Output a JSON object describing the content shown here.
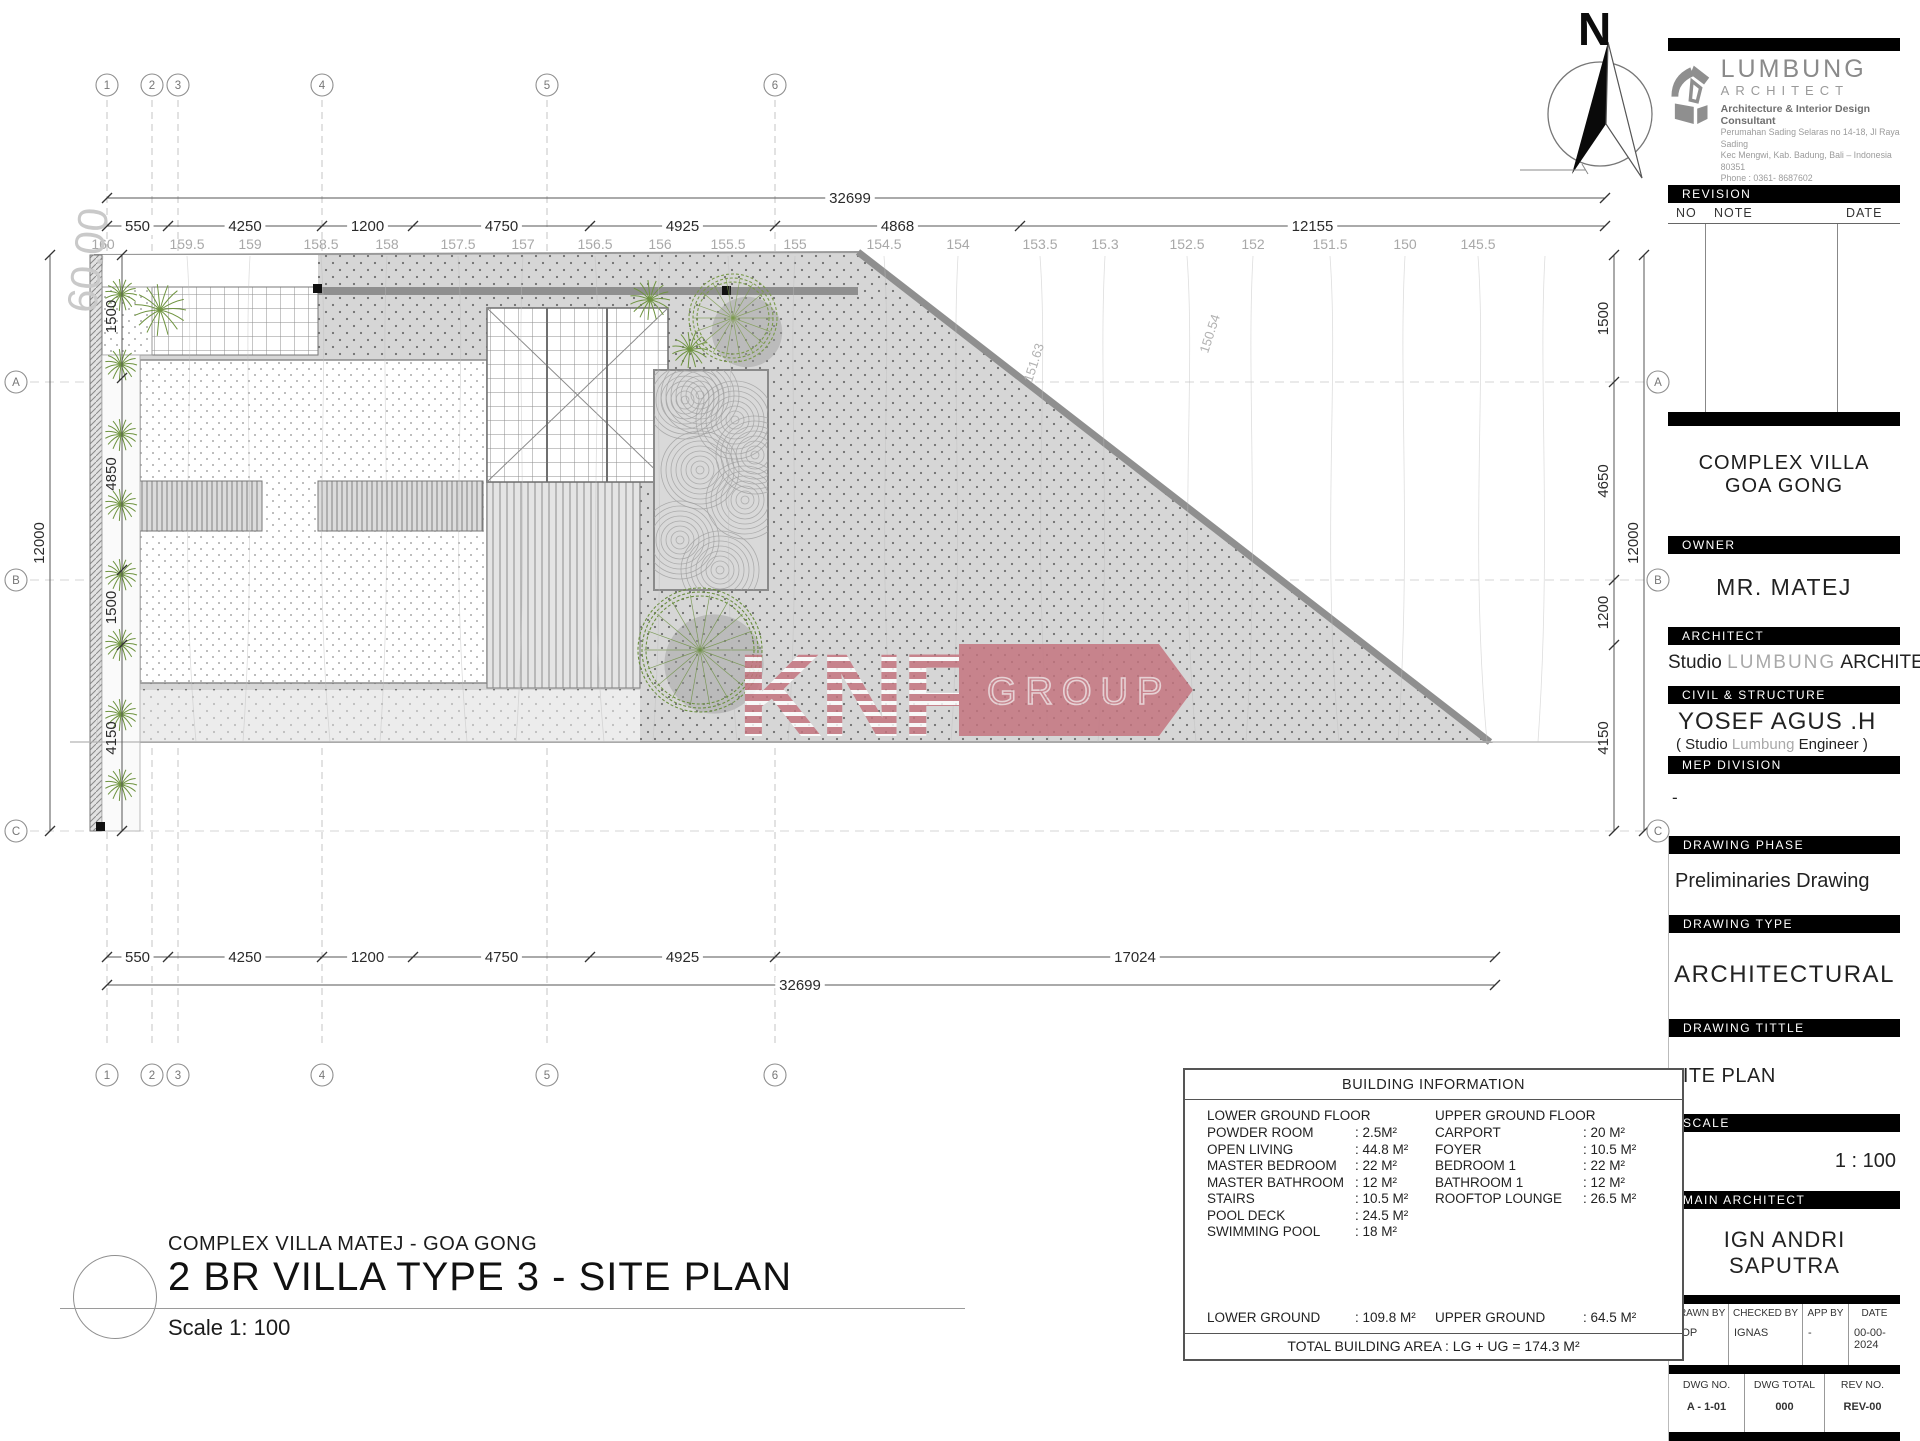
{
  "north": {
    "label": "N"
  },
  "logo": {
    "name": "LUMBUNG",
    "subname": "ARCHITECT",
    "tagline": "Architecture & Interior Design Consultant",
    "address1": "Perumahan Sading Selaras no 14-18, Jl Raya Sading",
    "address2": "Kec Mengwi, Kab. Badung, Bali – Indonesia 80351",
    "phone": "Phone : 0361- 8687602",
    "email": "Email   : info@lumbungarchitect.com"
  },
  "revision": {
    "header": "REVISION",
    "col_no": "NO",
    "col_note": "NOTE",
    "col_date": "DATE"
  },
  "title_block": {
    "project_line1": "COMPLEX VILLA",
    "project_line2": "GOA GONG",
    "owner_label": "OWNER",
    "owner": "MR. MATEJ",
    "architect_label": "ARCHITECT",
    "architect_prefix": "Studio",
    "architect_mid": "LUMBUNG",
    "architect_suffix": "ARCHITECT",
    "civil_label": "CIVIL & STRUCTURE",
    "civil_name": "YOSEF AGUS .H",
    "civil_sub_prefix": "( Studio",
    "civil_sub_mid": "Lumbung",
    "civil_sub_suffix": "Engineer )",
    "mep_label": "MEP DIVISION",
    "mep_value": "-",
    "phase_label": "DRAWING PHASE",
    "phase_value": "Preliminaries Drawing",
    "type_label": "DRAWING TYPE",
    "type_value": "ARCHITECTURAL",
    "title_label": "DRAWING TITTLE",
    "title_value": "SITE PLAN",
    "scale_label": "SCALE",
    "scale_value": "1 : 100",
    "main_architect_label": "MAIN ARCHITECT",
    "main_architect": "IGN ANDRI SAPUTRA",
    "meta": {
      "drawn_by_label": "DRAWN BY",
      "checked_by_label": "CHECKED BY",
      "app_by_label": "APP BY",
      "date_label": "DATE",
      "drawn_by": "POP",
      "checked_by": "IGNAS",
      "app_by": "-",
      "date": "00-00-2024"
    },
    "dwg": {
      "no_label": "DWG NO.",
      "total_label": "DWG TOTAL",
      "rev_label": "REV NO.",
      "no": "A - 1-01",
      "total": "000",
      "rev": "REV-00"
    }
  },
  "building_info": {
    "title": "BUILDING INFORMATION",
    "lower": {
      "header": "LOWER GROUND FLOOR",
      "rows": [
        [
          "POWDER ROOM",
          ": 2.5M²"
        ],
        [
          "OPEN LIVING",
          ": 44.8 M²"
        ],
        [
          "MASTER BEDROOM",
          ": 22 M²"
        ],
        [
          "MASTER BATHROOM",
          ": 12 M²"
        ],
        [
          "STAIRS",
          ": 10.5 M²"
        ],
        [
          "POOL DECK",
          ": 24.5 M²"
        ],
        [
          "SWIMMING POOL",
          ": 18 M²"
        ]
      ]
    },
    "upper": {
      "header": "UPPER GROUND FLOOR",
      "rows": [
        [
          "CARPORT",
          ": 20   M²"
        ],
        [
          "FOYER",
          ": 10.5 M²"
        ],
        [
          "BEDROOM 1",
          ": 22   M²"
        ],
        [
          "BATHROOM 1",
          ": 12   M²"
        ],
        [
          "ROOFTOP LOUNGE",
          ": 26.5 M²"
        ]
      ]
    },
    "totals": [
      [
        "LOWER GROUND",
        ": 109.8 M²"
      ],
      [
        "UPPER GROUND",
        ": 64.5 M²"
      ]
    ],
    "grand_total": "TOTAL BUILDING AREA : LG + UG = 174.3 M²"
  },
  "sheet_title": {
    "project": "COMPLEX VILLA MATEJ - GOA GONG",
    "title": "2 BR VILLA TYPE 3 - SITE PLAN",
    "scale": "Scale 1: 100"
  },
  "watermark": {
    "letters": "KNF",
    "banner": "GROUP",
    "color": "#c4737e"
  },
  "plan": {
    "grid_columns": {
      "labels": [
        "1",
        "2",
        "3",
        "4",
        "5",
        "6"
      ],
      "x": [
        107,
        152,
        178,
        322,
        547,
        775
      ],
      "bubble_top_y": 85,
      "bubble_bottom_y": 1075,
      "line_y1": 100,
      "line_y2": 1048
    },
    "grid_rows": {
      "labels": [
        "A",
        "B",
        "C"
      ],
      "y": [
        382,
        580,
        831
      ],
      "bubble_left_x": 16,
      "bubble_right_x": 1658
    },
    "dims_top": {
      "total": {
        "label": "32699",
        "x1": 107,
        "x2": 1605,
        "y": 198
      },
      "segments": {
        "y": 226,
        "bounds": [
          107,
          168,
          322,
          413,
          590,
          775,
          1020,
          1605
        ],
        "labels": [
          "550",
          "4250",
          "1200",
          "4750",
          "4925",
          "4868",
          "12155"
        ]
      }
    },
    "contour_labels": {
      "y": 249,
      "values": [
        "160",
        "159.5",
        "159",
        "158.5",
        "158",
        "157.5",
        "157",
        "156.5",
        "156",
        "155.5",
        "155",
        "154.5",
        "154",
        "153.5",
        "15.3",
        "152.5",
        "152",
        "151.5",
        "150",
        "145.5"
      ],
      "x": [
        103,
        187,
        250,
        321,
        387,
        458,
        523,
        595,
        660,
        728,
        795,
        884,
        958,
        1040,
        1105,
        1187,
        1253,
        1330,
        1405,
        1478
      ]
    },
    "dims_bottom": {
      "segments": {
        "y": 957,
        "bounds": [
          107,
          168,
          322,
          413,
          590,
          775,
          1495
        ],
        "labels": [
          "550",
          "4250",
          "1200",
          "4750",
          "4925",
          "17024"
        ]
      },
      "total": {
        "label": "32699",
        "x1": 107,
        "x2": 1495,
        "y": 985
      }
    },
    "dims_left": {
      "total": {
        "label": "12000",
        "x": 50,
        "y1": 255,
        "y2": 831
      },
      "segments": {
        "x": 122,
        "bounds": [
          255,
          378,
          570,
          645,
          831
        ],
        "labels": [
          "1500",
          "4850",
          "1500",
          "4150"
        ]
      }
    },
    "dims_right": {
      "total": {
        "label": "12000",
        "x": 1644,
        "y1": 255,
        "y2": 831
      },
      "segments": {
        "x": 1614,
        "bounds": [
          255,
          382,
          580,
          645,
          831
        ],
        "labels": [
          "1500",
          "4650",
          "1200",
          "4150"
        ]
      }
    },
    "annotations": [
      {
        "t": "60.00",
        "x": 102,
        "y": 262,
        "rot": -83,
        "size": 42,
        "color": "#c9c9c9"
      },
      {
        "t": "151.63",
        "x": 1038,
        "y": 364,
        "rot": -72,
        "size": 13,
        "color": "#b2b2b2"
      },
      {
        "t": "150.54",
        "x": 1214,
        "y": 335,
        "rot": -72,
        "size": 13,
        "color": "#b2b2b2"
      }
    ],
    "contour_xs": [
      103,
      187,
      250,
      321,
      387,
      458,
      523,
      595,
      660,
      728,
      795,
      884,
      958,
      1040,
      1105,
      1187,
      1253,
      1330,
      1405,
      1478,
      1545
    ]
  }
}
